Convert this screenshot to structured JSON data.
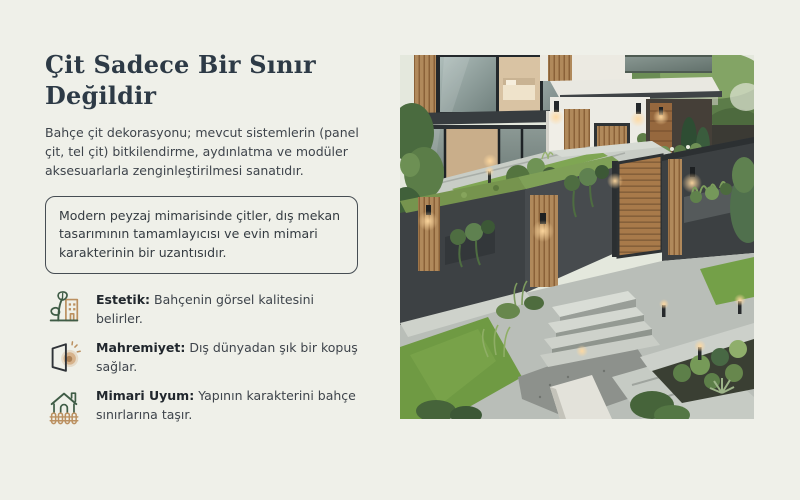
{
  "slide": {
    "background": "#eff0e9",
    "title": "Çit Sadece Bir Sınır Değildir",
    "title_lines": [
      "Çit Sadece Bir Sınır",
      "Değildir"
    ],
    "intro": "Bahçe çit dekorasyonu; mevcut sistemlerin (panel çit, tel çit) bitkilendirme, aydınlatma ve modüler aksesuarlarla zenginleştirilmesi sanatıdır.",
    "highlight": "Modern peyzaj mimarisinde çitler, dış mekan tasarımının tamamlayıcısı ve evin mimari karakterinin bir uzantısıdır.",
    "features": [
      {
        "icon": "leaf-building-icon",
        "label": "Estetik:",
        "text": "Bahçenin görsel kalitesini belirler."
      },
      {
        "icon": "open-door-light-icon",
        "label": "Mahremiyet:",
        "text": "Dış dünyadan şık bir kopuş sağlar."
      },
      {
        "icon": "house-fence-icon",
        "label": "Mimari Uyum:",
        "text": "Yapının karakterini bahçe sınırlarına taşır."
      }
    ],
    "photo": {
      "alt": "Modern evin bahçesi: antrasit ve ahşap çit panelleri, yeşil çatılı duvarlar, dikey bahçeler, beton yollar ve peyzaj aydınlatması"
    },
    "palette": {
      "title_color": "#2d3a46",
      "body_color": "#3e444b",
      "box_border": "#464d53",
      "icon_green": "#3f5c46",
      "icon_tan": "#bb9060",
      "fence_charcoal": "#3d4144",
      "wood": "#a87a4a",
      "lawn_green": "#76a046"
    }
  }
}
